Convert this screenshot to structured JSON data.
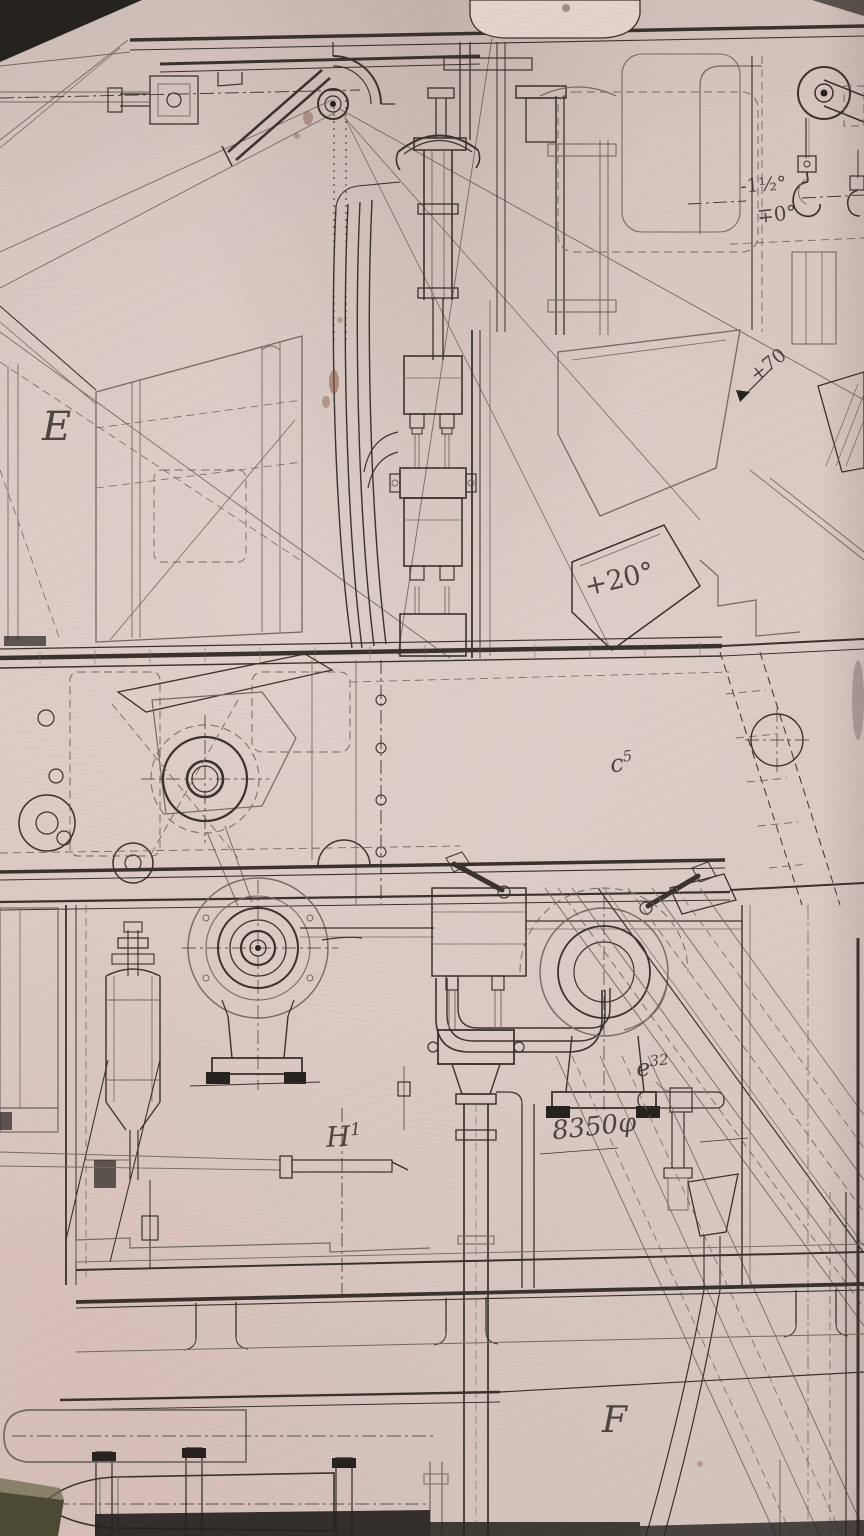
{
  "drawing": {
    "kind": "scanned engineering blueprint, machinery sectional elevation",
    "components": [
      "hoist-pulley-with-hook",
      "elevation-quadrant-and-hub",
      "recoil-cylinder",
      "control-valve-column",
      "piping-runs",
      "worm-gear-housing",
      "centrifugal-pump",
      "blower-casing",
      "accumulator-cylinder",
      "inclined-rails",
      "ladder-frame",
      "deck-beams-with-brackets",
      "torpedo-on-rack",
      "tee-handle-valve"
    ]
  },
  "labels": {
    "section_e": {
      "text": "E"
    },
    "section_f": {
      "text": "F"
    },
    "part_c5": {
      "base": "c",
      "sup": "5"
    },
    "part_h1": {
      "base": "H",
      "sup": "1"
    },
    "part_e32": {
      "base": "e",
      "sup": "32"
    },
    "angle_plus20": {
      "text": "+20°"
    },
    "angle_plus70": {
      "text": "+70"
    },
    "angle_minus15": {
      "text": "-1½°"
    },
    "angle_zero": {
      "text": "∓0°"
    },
    "dim_diameter": {
      "text": "8350φ"
    }
  },
  "palette": {
    "paper": "#d9c6c0",
    "paper_light": "#e2d3cc",
    "ink": "#3a332d",
    "ink_faint": "#746a61",
    "dark_fill": "#262220",
    "stain": "#8a5a44",
    "olive": "#4b4a33"
  }
}
